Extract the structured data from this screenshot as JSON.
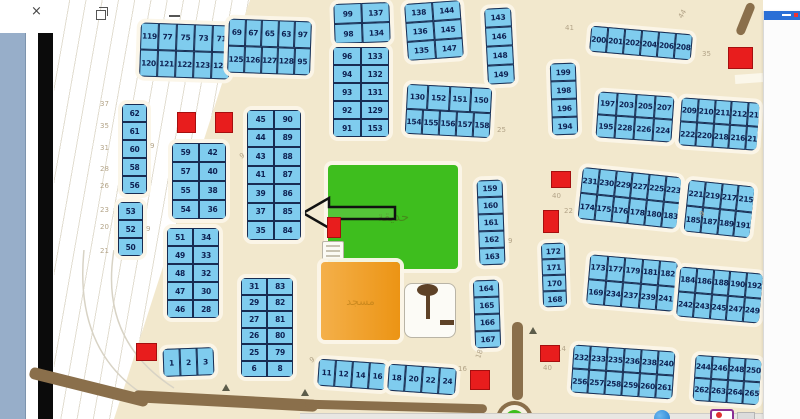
{
  "window": {
    "close_glyph": "×"
  },
  "colors": {
    "beige": "#f2e8cd",
    "plot_fill": "#7fccee",
    "plot_border": "#182c52",
    "plot_text": "#0e2152",
    "park_green": "#3ebe1e",
    "mosque_orange": "#ec9414",
    "red_mark": "#e81d1d",
    "road_brown": "#8a6f4b",
    "panel_blue": "#2a6fd6",
    "measure_text": "#b3a488"
  },
  "park_label": "حديقة",
  "mosque_label": "مسجد",
  "blocks": [
    {
      "id": "blk-119",
      "x": 140,
      "y": 24,
      "rot": 2,
      "cw": 18,
      "ch": 27,
      "rows": [
        [
          "119",
          "77",
          "75",
          "73",
          "71"
        ],
        [
          "120",
          "121",
          "122",
          "123",
          "124"
        ]
      ]
    },
    {
      "id": "blk-69",
      "x": 228,
      "y": 20,
      "rot": 2,
      "cw": 16.5,
      "ch": 27,
      "rows": [
        [
          "69",
          "67",
          "65",
          "63",
          "97"
        ],
        [
          "125",
          "126",
          "127",
          "128",
          "95"
        ]
      ]
    },
    {
      "id": "blk-99",
      "x": 334,
      "y": 3,
      "rot": -2,
      "cw": 28,
      "ch": 20,
      "rows": [
        [
          "99",
          "137"
        ],
        [
          "98",
          "134"
        ]
      ]
    },
    {
      "id": "blk-96",
      "x": 333,
      "y": 47,
      "rot": 0,
      "cw": 28,
      "ch": 18,
      "rows": [
        [
          "96",
          "133"
        ],
        [
          "94",
          "132"
        ],
        [
          "93",
          "131"
        ],
        [
          "92",
          "129"
        ],
        [
          "91",
          "153"
        ]
      ]
    },
    {
      "id": "blk-138",
      "x": 406,
      "y": 2,
      "rot": -4,
      "cw": 28,
      "ch": 19,
      "rows": [
        [
          "138",
          "144"
        ],
        [
          "136",
          "145"
        ],
        [
          "135",
          "147"
        ]
      ]
    },
    {
      "id": "blk-143",
      "x": 486,
      "y": 8,
      "rot": -3,
      "cw": 27,
      "ch": 19,
      "rows": [
        [
          "143"
        ],
        [
          "146"
        ],
        [
          "148"
        ],
        [
          "149"
        ]
      ]
    },
    {
      "id": "blk-130",
      "x": 406,
      "y": 86,
      "rot": 3,
      "cw": 17,
      "ch": 25,
      "rows": [
        [
          "130",
          "152",
          "151",
          "150"
        ],
        [
          "154",
          "155",
          "156",
          "157",
          "158"
        ]
      ]
    },
    {
      "id": "blk-200",
      "x": 590,
      "y": 30,
      "rot": 5,
      "cw": 17,
      "ch": 26,
      "rows": [
        [
          "200",
          "201",
          "202",
          "204",
          "206",
          "208"
        ]
      ]
    },
    {
      "id": "blk-199",
      "x": 551,
      "y": 63,
      "rot": -2,
      "cw": 26,
      "ch": 18,
      "rows": [
        [
          "199"
        ],
        [
          "198"
        ],
        [
          "196"
        ],
        [
          "194"
        ]
      ]
    },
    {
      "id": "blk-197",
      "x": 597,
      "y": 94,
      "rot": 4,
      "cw": 19,
      "ch": 23,
      "rows": [
        [
          "197",
          "203",
          "205",
          "207"
        ],
        [
          "195",
          "228",
          "226",
          "224"
        ]
      ]
    },
    {
      "id": "blk-209",
      "x": 680,
      "y": 100,
      "rot": 4,
      "cw": 15.5,
      "ch": 24,
      "rows": [
        [
          "209",
          "210",
          "211",
          "212",
          "213"
        ],
        [
          "222",
          "220",
          "218",
          "216",
          "214"
        ]
      ]
    },
    {
      "id": "blk-62",
      "x": 122,
      "y": 104,
      "rot": 0,
      "cw": 25,
      "ch": 18,
      "rows": [
        [
          "62"
        ],
        [
          "61"
        ],
        [
          "60"
        ],
        [
          "58"
        ],
        [
          "56"
        ]
      ]
    },
    {
      "id": "blk-53",
      "x": 118,
      "y": 202,
      "rot": 0,
      "cw": 25,
      "ch": 18,
      "rows": [
        [
          "53"
        ],
        [
          "52"
        ],
        [
          "50"
        ]
      ]
    },
    {
      "id": "blk-59",
      "x": 172,
      "y": 143,
      "rot": 0,
      "cw": 27,
      "ch": 19,
      "rows": [
        [
          "59",
          "42"
        ],
        [
          "57",
          "40"
        ],
        [
          "55",
          "38"
        ],
        [
          "54",
          "36"
        ]
      ]
    },
    {
      "id": "blk-51",
      "x": 167,
      "y": 228,
      "rot": 0,
      "cw": 26,
      "ch": 18,
      "rows": [
        [
          "51",
          "34"
        ],
        [
          "49",
          "33"
        ],
        [
          "48",
          "32"
        ],
        [
          "47",
          "30"
        ],
        [
          "46",
          "28"
        ]
      ]
    },
    {
      "id": "blk-45",
      "x": 247,
      "y": 110,
      "rot": 0,
      "cw": 27,
      "ch": 18.5,
      "rows": [
        [
          "45",
          "90"
        ],
        [
          "44",
          "89"
        ],
        [
          "43",
          "88"
        ],
        [
          "41",
          "87"
        ],
        [
          "39",
          "86"
        ],
        [
          "37",
          "85"
        ],
        [
          "35",
          "84"
        ]
      ]
    },
    {
      "id": "blk-31",
      "x": 241,
      "y": 278,
      "rot": 0,
      "cw": 26,
      "ch": 16.5,
      "rows": [
        [
          "31",
          "83"
        ],
        [
          "29",
          "82"
        ],
        [
          "27",
          "81"
        ],
        [
          "26",
          "80"
        ],
        [
          "25",
          "79"
        ],
        [
          "6",
          "8"
        ]
      ]
    },
    {
      "id": "blk-1",
      "x": 163,
      "y": 348,
      "rot": -2,
      "cw": 17,
      "ch": 28,
      "rows": [
        [
          "1",
          "2",
          "3"
        ]
      ]
    },
    {
      "id": "blk-11",
      "x": 318,
      "y": 361,
      "rot": 4,
      "cw": 17,
      "ch": 27,
      "rows": [
        [
          "11",
          "12",
          "14",
          "16"
        ]
      ]
    },
    {
      "id": "blk-18",
      "x": 388,
      "y": 366,
      "rot": 4,
      "cw": 17,
      "ch": 27,
      "rows": [
        [
          "18",
          "20",
          "22",
          "24"
        ]
      ]
    },
    {
      "id": "blk-159",
      "x": 478,
      "y": 180,
      "rot": -2,
      "cw": 26,
      "ch": 17,
      "rows": [
        [
          "159"
        ],
        [
          "160"
        ],
        [
          "161"
        ],
        [
          "162"
        ],
        [
          "163"
        ]
      ]
    },
    {
      "id": "blk-164",
      "x": 474,
      "y": 280,
      "rot": -2,
      "cw": 26,
      "ch": 17,
      "rows": [
        [
          "164"
        ],
        [
          "165"
        ],
        [
          "166"
        ],
        [
          "167"
        ]
      ]
    },
    {
      "id": "blk-231",
      "x": 580,
      "y": 172,
      "rot": 6,
      "cw": 16.5,
      "ch": 26,
      "rows": [
        [
          "231",
          "230",
          "229",
          "227",
          "225",
          "223"
        ],
        [
          "174",
          "175",
          "176",
          "178",
          "180",
          "183"
        ]
      ]
    },
    {
      "id": "blk-221",
      "x": 686,
      "y": 183,
      "rot": 6,
      "cw": 16.5,
      "ch": 26,
      "rows": [
        [
          "221",
          "219",
          "217",
          "215"
        ],
        [
          "185",
          "187",
          "189",
          "191"
        ]
      ]
    },
    {
      "id": "blk-172",
      "x": 542,
      "y": 243,
      "rot": -2,
      "cw": 24,
      "ch": 16,
      "rows": [
        [
          "172"
        ],
        [
          "171"
        ],
        [
          "170"
        ],
        [
          "168"
        ]
      ]
    },
    {
      "id": "blk-173",
      "x": 588,
      "y": 258,
      "rot": 5,
      "cw": 17.5,
      "ch": 25,
      "rows": [
        [
          "173",
          "177",
          "179",
          "181",
          "182"
        ],
        [
          "169",
          "234",
          "237",
          "239",
          "241"
        ]
      ]
    },
    {
      "id": "blk-184",
      "x": 678,
      "y": 270,
      "rot": 5,
      "cw": 16.5,
      "ch": 25,
      "rows": [
        [
          "184",
          "186",
          "188",
          "190",
          "192"
        ],
        [
          "242",
          "243",
          "245",
          "247",
          "249"
        ]
      ]
    },
    {
      "id": "blk-232",
      "x": 572,
      "y": 348,
      "rot": 4,
      "cw": 17,
      "ch": 24,
      "rows": [
        [
          "232",
          "233",
          "235",
          "236",
          "238",
          "240"
        ],
        [
          "256",
          "257",
          "258",
          "259",
          "260",
          "261"
        ]
      ]
    },
    {
      "id": "blk-244",
      "x": 694,
      "y": 357,
      "rot": 4,
      "cw": 16.5,
      "ch": 23,
      "rows": [
        [
          "244",
          "246",
          "248",
          "250"
        ],
        [
          "262",
          "263",
          "264",
          "265"
        ]
      ]
    }
  ],
  "measurements": [
    {
      "t": "37",
      "x": 100,
      "y": 100
    },
    {
      "t": "35",
      "x": 100,
      "y": 122
    },
    {
      "t": "31",
      "x": 100,
      "y": 144
    },
    {
      "t": "28",
      "x": 100,
      "y": 165
    },
    {
      "t": "26",
      "x": 100,
      "y": 182
    },
    {
      "t": "23",
      "x": 100,
      "y": 206
    },
    {
      "t": "20",
      "x": 100,
      "y": 223
    },
    {
      "t": "21",
      "x": 100,
      "y": 247
    },
    {
      "t": "41",
      "x": 565,
      "y": 24
    },
    {
      "t": "44",
      "x": 678,
      "y": 10,
      "r": -60
    },
    {
      "t": "35",
      "x": 702,
      "y": 50
    },
    {
      "t": "25",
      "x": 497,
      "y": 126
    },
    {
      "t": "40",
      "x": 552,
      "y": 192
    },
    {
      "t": "22",
      "x": 564,
      "y": 207
    },
    {
      "t": "14",
      "x": 557,
      "y": 345
    },
    {
      "t": "40",
      "x": 543,
      "y": 364
    },
    {
      "t": "18",
      "x": 475,
      "y": 350,
      "r": -70
    },
    {
      "t": "16",
      "x": 458,
      "y": 365
    },
    {
      "t": "9",
      "x": 150,
      "y": 142
    },
    {
      "t": "9",
      "x": 146,
      "y": 225
    },
    {
      "t": "9",
      "x": 240,
      "y": 152,
      "r": -30
    },
    {
      "t": "9",
      "x": 508,
      "y": 237
    },
    {
      "t": "9",
      "x": 700,
      "y": 210,
      "r": -30
    },
    {
      "t": "9",
      "x": 310,
      "y": 356,
      "r": -30
    }
  ],
  "red_marks": [
    [
      177,
      112,
      17,
      19
    ],
    [
      215,
      112,
      16,
      19
    ],
    [
      327,
      217,
      12,
      19
    ],
    [
      136,
      343,
      19,
      16
    ],
    [
      470,
      370,
      18,
      18
    ],
    [
      728,
      47,
      23,
      20
    ],
    [
      551,
      171,
      18,
      15
    ],
    [
      543,
      210,
      14,
      21
    ],
    [
      540,
      345,
      18,
      15
    ]
  ],
  "markers": [
    [
      222,
      384
    ],
    [
      301,
      389
    ],
    [
      529,
      327
    ]
  ]
}
